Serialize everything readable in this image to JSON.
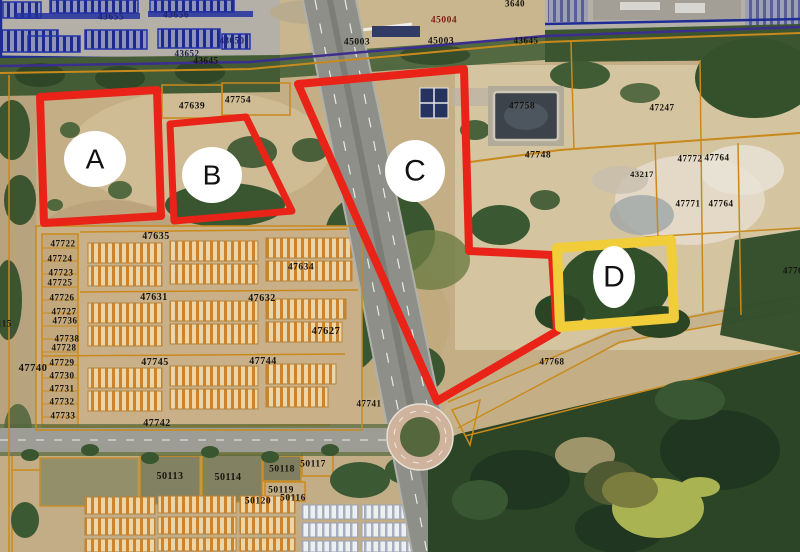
{
  "map": {
    "colors": {
      "region_red": "#e92318",
      "region_yellow": "#f0cd39",
      "parcel_line_orange": "#c98a1b",
      "parking_line_blue": "#2433a8",
      "boundary_purple": "#3b2e8f",
      "marker_fill": "#ffffff"
    },
    "annotation_regions": [
      {
        "letter": "A",
        "points": "40,97 157,90 161,216 44,223",
        "stroke": "#e92318",
        "stroke_width": 8,
        "marker": {
          "cx": 95,
          "cy": 159,
          "rx": 31,
          "ry": 28,
          "font_size": 28
        }
      },
      {
        "letter": "B",
        "points": "170,124 246,117 292,211 174,221",
        "stroke": "#e92318",
        "stroke_width": 7,
        "marker": {
          "cx": 212,
          "cy": 175,
          "rx": 30,
          "ry": 28,
          "font_size": 28
        }
      },
      {
        "letter": "C",
        "points": "298,84 464,69 469,251 552,255 557,331 437,401",
        "stroke": "#e92318",
        "stroke_width": 8,
        "marker": {
          "cx": 415,
          "cy": 171,
          "rx": 30,
          "ry": 31,
          "font_size": 30
        }
      },
      {
        "letter": "D",
        "points": "557,248 671,240 674,318 560,327",
        "stroke": "#f0cd39",
        "stroke_width": 10,
        "marker": {
          "cx": 614,
          "cy": 277,
          "rx": 21,
          "ry": 31,
          "font_size": 30
        }
      }
    ],
    "parcel_labels": [
      {
        "text": "43655",
        "x": 111,
        "y": 18,
        "color": "#1c2470",
        "size": 9.5
      },
      {
        "text": "43656",
        "x": 176,
        "y": 16,
        "color": "#1c2470",
        "size": 9.5
      },
      {
        "text": "43650",
        "x": 232,
        "y": 41,
        "color": "#1c2470",
        "size": 9
      },
      {
        "text": "43652",
        "x": 187,
        "y": 54,
        "color": "#1a1f4e",
        "size": 9
      },
      {
        "text": "43645",
        "x": 206,
        "y": 61,
        "color": "#16140f",
        "size": 9
      },
      {
        "text": "45003",
        "x": 357,
        "y": 43,
        "color": "#16140f",
        "size": 9.5
      },
      {
        "text": "45004",
        "x": 444,
        "y": 21,
        "color": "#7e1d15",
        "size": 9.5
      },
      {
        "text": "45003",
        "x": 441,
        "y": 42,
        "color": "#16140f",
        "size": 9.5
      },
      {
        "text": "3640",
        "x": 515,
        "y": 4,
        "color": "#16140f",
        "size": 9
      },
      {
        "text": "43645",
        "x": 526,
        "y": 41,
        "color": "#16140f",
        "size": 9
      },
      {
        "text": "47247",
        "x": 662,
        "y": 108,
        "color": "#16140f",
        "size": 9
      },
      {
        "text": "47758",
        "x": 522,
        "y": 107,
        "color": "#16140f",
        "size": 9.5
      },
      {
        "text": "47748",
        "x": 538,
        "y": 156,
        "color": "#16140f",
        "size": 9.5
      },
      {
        "text": "47772",
        "x": 690,
        "y": 159,
        "color": "#16140f",
        "size": 9
      },
      {
        "text": "47764",
        "x": 717,
        "y": 158,
        "color": "#16140f",
        "size": 9
      },
      {
        "text": "43217",
        "x": 642,
        "y": 174,
        "color": "#16140f",
        "size": 8.5
      },
      {
        "text": "47771",
        "x": 688,
        "y": 204,
        "color": "#16140f",
        "size": 9
      },
      {
        "text": "47764",
        "x": 721,
        "y": 204,
        "color": "#16140f",
        "size": 9
      },
      {
        "text": "4776",
        "x": 793,
        "y": 271,
        "color": "#16140f",
        "size": 9
      },
      {
        "text": "47768",
        "x": 552,
        "y": 362,
        "color": "#16140f",
        "size": 9
      },
      {
        "text": "47741",
        "x": 369,
        "y": 404,
        "color": "#16140f",
        "size": 9
      },
      {
        "text": "47639",
        "x": 192,
        "y": 107,
        "color": "#16140f",
        "size": 9.5
      },
      {
        "text": "47754",
        "x": 238,
        "y": 101,
        "color": "#16140f",
        "size": 9.5
      },
      {
        "text": "47635",
        "x": 156,
        "y": 237,
        "color": "#16140f",
        "size": 10
      },
      {
        "text": "47634",
        "x": 301,
        "y": 268,
        "color": "#16140f",
        "size": 9.5
      },
      {
        "text": "47631",
        "x": 154,
        "y": 298,
        "color": "#16140f",
        "size": 10
      },
      {
        "text": "47632",
        "x": 262,
        "y": 299,
        "color": "#16140f",
        "size": 10
      },
      {
        "text": "47627",
        "x": 326,
        "y": 332,
        "color": "#16140f",
        "size": 10.5
      },
      {
        "text": "47745",
        "x": 155,
        "y": 363,
        "color": "#16140f",
        "size": 10
      },
      {
        "text": "47744",
        "x": 263,
        "y": 362,
        "color": "#16140f",
        "size": 10
      },
      {
        "text": "47742",
        "x": 157,
        "y": 424,
        "color": "#16140f",
        "size": 10
      },
      {
        "text": "50113",
        "x": 170,
        "y": 477,
        "color": "#16140f",
        "size": 10
      },
      {
        "text": "50114",
        "x": 228,
        "y": 478,
        "color": "#16140f",
        "size": 10
      },
      {
        "text": "50118",
        "x": 282,
        "y": 470,
        "color": "#16140f",
        "size": 9.5
      },
      {
        "text": "50117",
        "x": 313,
        "y": 465,
        "color": "#16140f",
        "size": 9.5
      },
      {
        "text": "50119",
        "x": 281,
        "y": 491,
        "color": "#16140f",
        "size": 9.5
      },
      {
        "text": "50120",
        "x": 258,
        "y": 502,
        "color": "#16140f",
        "size": 9.5
      },
      {
        "text": "50116",
        "x": 293,
        "y": 499,
        "color": "#16140f",
        "size": 9.5
      },
      {
        "text": "47722",
        "x": 63,
        "y": 244,
        "color": "#16140f",
        "size": 9
      },
      {
        "text": "47724",
        "x": 60,
        "y": 259,
        "color": "#16140f",
        "size": 9
      },
      {
        "text": "47723",
        "x": 61,
        "y": 273,
        "color": "#16140f",
        "size": 9
      },
      {
        "text": "47725",
        "x": 60,
        "y": 283,
        "color": "#16140f",
        "size": 9
      },
      {
        "text": "47726",
        "x": 62,
        "y": 298,
        "color": "#16140f",
        "size": 9
      },
      {
        "text": "47727",
        "x": 64,
        "y": 312,
        "color": "#16140f",
        "size": 9
      },
      {
        "text": "47736",
        "x": 65,
        "y": 321,
        "color": "#16140f",
        "size": 9
      },
      {
        "text": "47738",
        "x": 67,
        "y": 339,
        "color": "#16140f",
        "size": 9
      },
      {
        "text": "47728",
        "x": 64,
        "y": 348,
        "color": "#16140f",
        "size": 9
      },
      {
        "text": "47729",
        "x": 62,
        "y": 363,
        "color": "#16140f",
        "size": 9
      },
      {
        "text": "47730",
        "x": 62,
        "y": 376,
        "color": "#16140f",
        "size": 9
      },
      {
        "text": "47731",
        "x": 62,
        "y": 389,
        "color": "#16140f",
        "size": 9
      },
      {
        "text": "47732",
        "x": 62,
        "y": 402,
        "color": "#16140f",
        "size": 9
      },
      {
        "text": "47733",
        "x": 63,
        "y": 416,
        "color": "#16140f",
        "size": 9
      },
      {
        "text": "47740",
        "x": 33,
        "y": 369,
        "color": "#16140f",
        "size": 10.5
      },
      {
        "text": "9115",
        "x": 2,
        "y": 324,
        "color": "#16140f",
        "size": 9
      }
    ]
  }
}
